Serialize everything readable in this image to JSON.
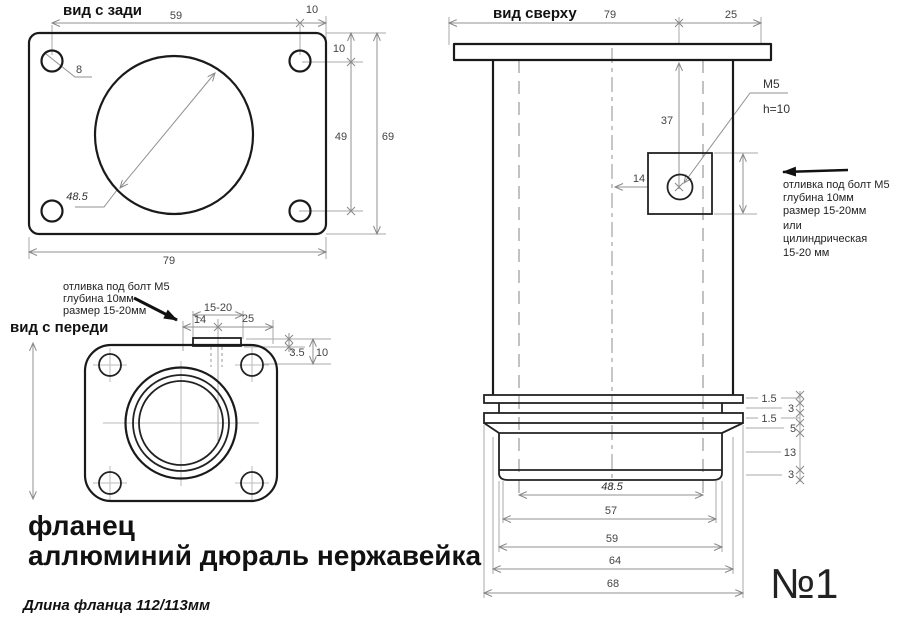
{
  "rear_view": {
    "title": "вид с зади",
    "dims": {
      "hole_spacing_h": "59",
      "edge_right": "10",
      "edge_top": "10",
      "hole_spacing_v": "49",
      "height": "69",
      "width": "79",
      "hole_dia": "8",
      "bore_dia": "48.5"
    }
  },
  "front_view": {
    "title": "вид с переди",
    "notes": [
      "отливка под болт М5",
      "глубина 10мм",
      "размер 15-20мм"
    ],
    "dims": {
      "slot_range": "15-20",
      "slot_left": "14",
      "slot_right": "25",
      "tab_height": "3.5",
      "tab_depth": "10"
    }
  },
  "top_view": {
    "title": "вид сверху",
    "dims": {
      "body_width": "79",
      "flange_right": "25",
      "boss_from_top": "37",
      "boss_from_center": "14",
      "thread": "М5",
      "thread_depth": "h=10"
    },
    "notes": [
      "отливка под болт М5",
      "глубина 10мм",
      "размер 15-20мм",
      "или",
      "цилиндрическая",
      "15-20 мм"
    ],
    "stack_dims": [
      "1.5",
      "3",
      "1.5",
      "5",
      "13",
      "3"
    ],
    "width_dims": [
      "48.5",
      "57",
      "59",
      "64",
      "68"
    ]
  },
  "footer": {
    "part_name": "фланец",
    "materials": "аллюминий дюраль нержавейка",
    "length_note": "Длина фланца 112/113мм"
  },
  "sheet_number": "№1",
  "colors": {
    "outline": "#1a1a1a",
    "dim_line": "#999999",
    "dim_text": "#444444",
    "background": "#ffffff"
  }
}
